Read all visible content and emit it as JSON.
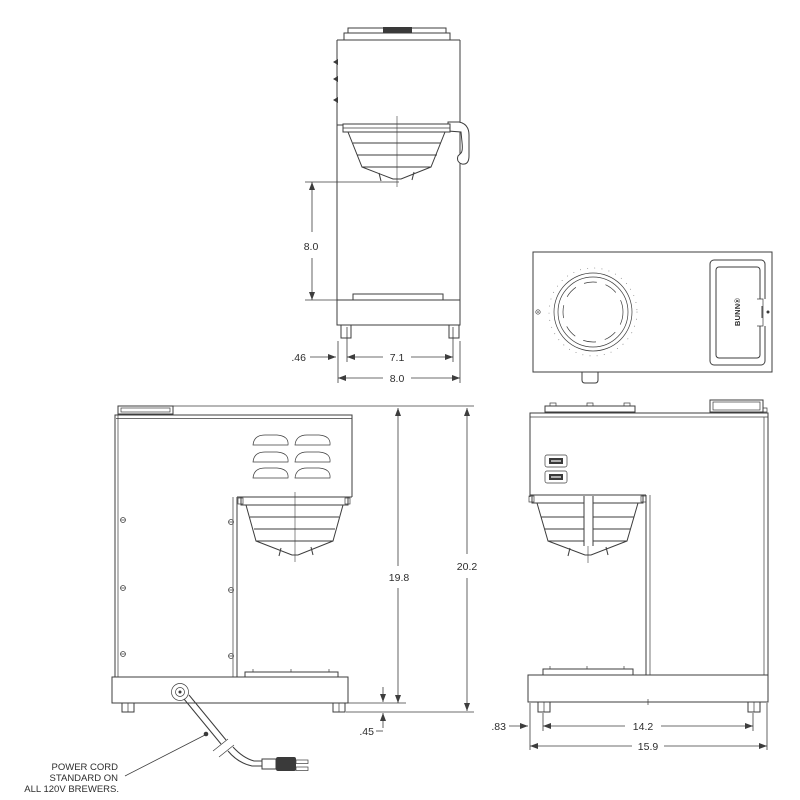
{
  "drawing_title": "coffee brewer specification drawing",
  "dims": {
    "front": {
      "clearance_height": "8.0",
      "foot_inset": ".46",
      "feet_span": "7.1",
      "overall_width": "8.0"
    },
    "side": {
      "body_height": "19.8",
      "overall_height": "20.2",
      "base_height": ".45",
      "foot_inset": ".83",
      "feet_span": "14.2",
      "overall_depth": "15.9"
    }
  },
  "note": {
    "lines": [
      "POWER CORD",
      "STANDARD ON",
      "ALL 120V BREWERS."
    ]
  },
  "brand": {
    "logo": "BUNN®"
  },
  "colors": {
    "line": "#3d3d3d",
    "background": "#ffffff"
  }
}
